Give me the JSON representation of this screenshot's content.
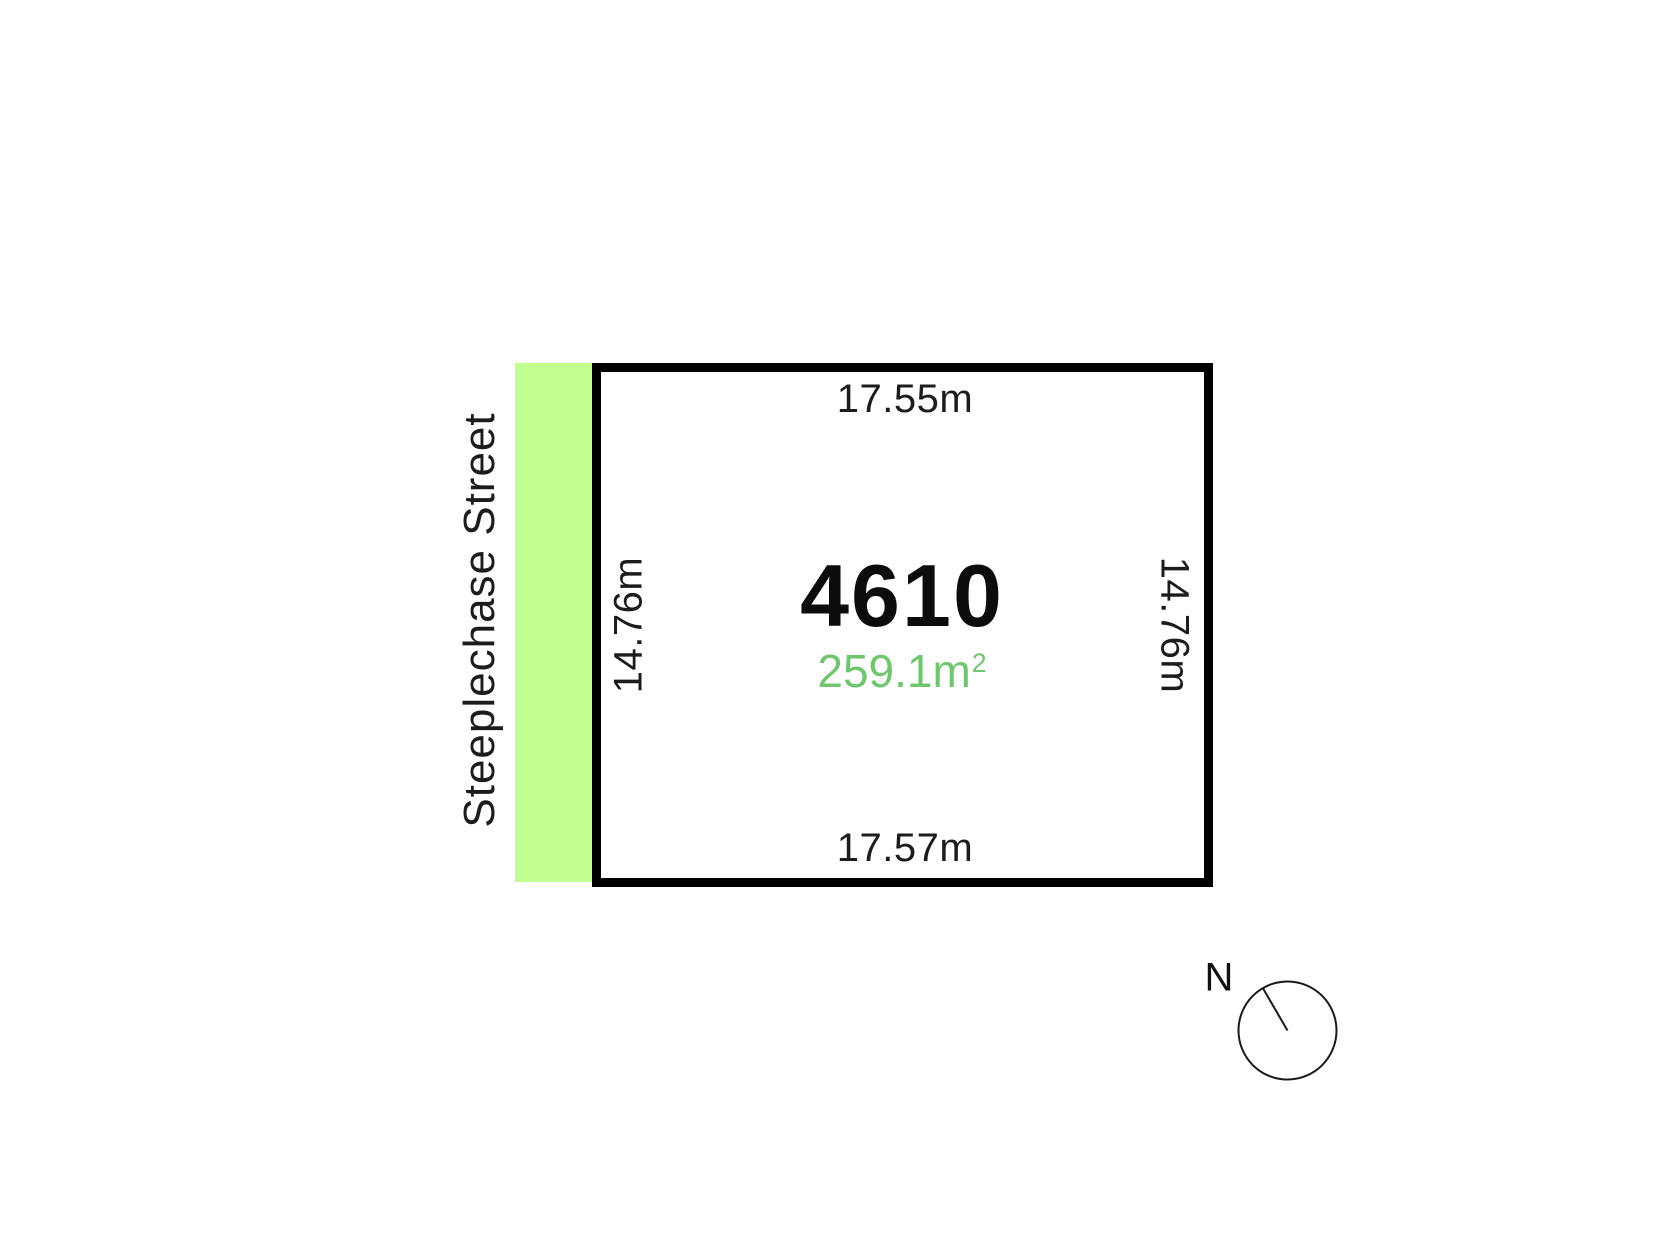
{
  "street": {
    "name": "Steeplechase Street"
  },
  "lot": {
    "number": "4610",
    "area_value": "259.1m",
    "area_exponent": "2",
    "dimensions": {
      "top": "17.55m",
      "right": "14.76m",
      "bottom": "17.57m",
      "left": "14.76m"
    }
  },
  "compass": {
    "label": "N"
  },
  "colors": {
    "street_fill": "#C1FD8F",
    "area_text": "#70C66E",
    "boundary": "#000000"
  }
}
